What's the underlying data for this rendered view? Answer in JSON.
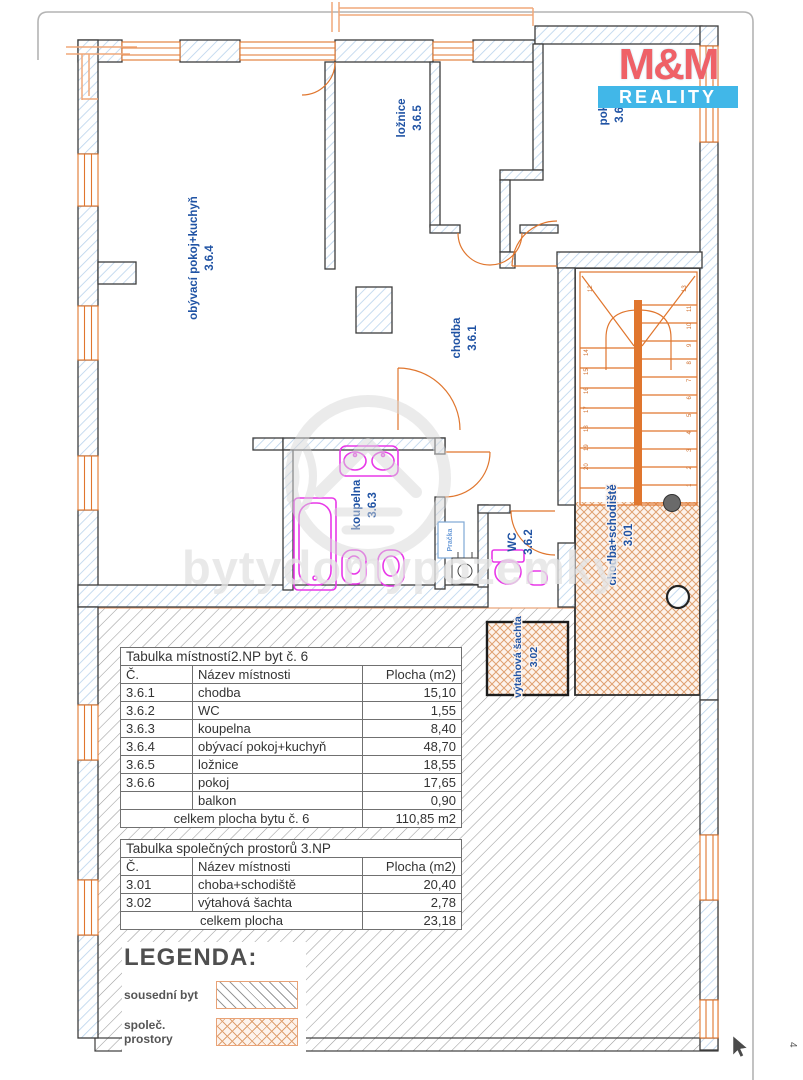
{
  "page": {
    "number": "4"
  },
  "logo": {
    "top": "M&M",
    "bottom": "REALITY"
  },
  "watermark": "bytydomypozemky",
  "plan": {
    "rooms": {
      "obyvaci": {
        "name": "obývací pokoj+kuchyň",
        "number": "3.6.4"
      },
      "loznice": {
        "name": "ložnice",
        "number": "3.6.5"
      },
      "pokoj": {
        "name": "pokoj",
        "number": "3.6.6"
      },
      "chodba": {
        "name": "chodba",
        "number": "3.6.1"
      },
      "koupelna": {
        "name": "koupelna",
        "number": "3.6.3"
      },
      "wc": {
        "name": "WC",
        "number": "3.6.2"
      },
      "schodiste": {
        "name": "chodba+schodiště",
        "number": "3.01"
      },
      "vytah": {
        "name": "výtahová šachta",
        "number": "3.02"
      }
    },
    "washer_label": "Pračka",
    "stair_numbers_left": [
      "14",
      "15",
      "16",
      "17",
      "18",
      "19",
      "20"
    ],
    "stair_numbers_right": [
      "11",
      "10",
      "9",
      "8",
      "7",
      "6",
      "5",
      "4",
      "3",
      "2",
      "1"
    ],
    "stair_numbers_top": [
      "12",
      "13"
    ]
  },
  "tables": [
    {
      "title": "Tabulka místností2.NP byt č. 6",
      "headers": [
        "Č.",
        "Název místnosti",
        "Plocha (m2)"
      ],
      "rows": [
        [
          "3.6.1",
          "chodba",
          "15,10"
        ],
        [
          "3.6.2",
          "WC",
          "1,55"
        ],
        [
          "3.6.3",
          "koupelna",
          "8,40"
        ],
        [
          "3.6.4",
          "obývací pokoj+kuchyň",
          "48,70"
        ],
        [
          "3.6.5",
          "ložnice",
          "18,55"
        ],
        [
          "3.6.6",
          "pokoj",
          "17,65"
        ],
        [
          "",
          "balkon",
          "0,90"
        ]
      ],
      "total_label": "celkem plocha bytu č. 6",
      "total_value": "110,85 m2"
    },
    {
      "title": "Tabulka společných prostorů 3.NP",
      "headers": [
        "Č.",
        "Název místnosti",
        "Plocha (m2)"
      ],
      "rows": [
        [
          "3.01",
          "choba+schodiště",
          "20,40"
        ],
        [
          "3.02",
          "výtahová šachta",
          "2,78"
        ]
      ],
      "total_label": "celkem plocha",
      "total_value": "23,18"
    }
  ],
  "legend": {
    "title": "LEGENDA:",
    "items": [
      {
        "label": "sousední byt",
        "swatch": "diagonal-hatch"
      },
      {
        "label": "společ. prostory",
        "swatch": "crosshatch"
      }
    ]
  },
  "colors": {
    "accent_orange": "#e0762e",
    "wall_hatch_blue": "#b9d3ec",
    "label_blue": "#2053a4",
    "fixture_magenta": "#e838e8",
    "logo_red": "#ef6167",
    "logo_cyan": "#41b7e8"
  }
}
